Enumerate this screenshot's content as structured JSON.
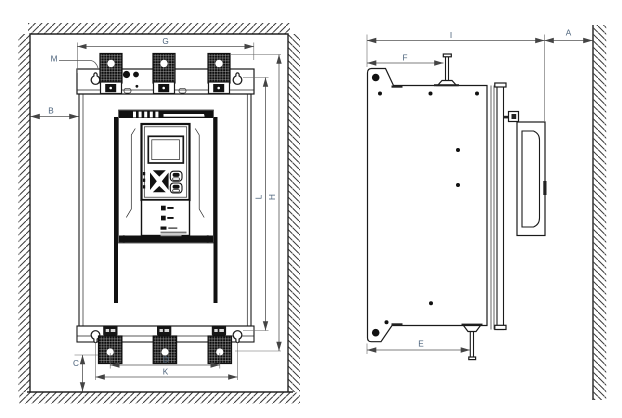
{
  "drawing": {
    "views": {
      "front_view": {
        "dimension_labels": {
          "G": "G",
          "M": "M",
          "B": "B",
          "C": "C",
          "D": "D",
          "K": "K",
          "L": "L",
          "H": "H"
        }
      },
      "side_view": {
        "dimension_labels": {
          "I": "I",
          "A": "A",
          "F": "F",
          "E": "E"
        }
      }
    },
    "colors": {
      "drawing_line": "#1a1a1a",
      "dimension_line": "#555555",
      "label_text": "#4a617a",
      "terminal_block": "#0d0d0d",
      "background": "#ffffff"
    }
  }
}
